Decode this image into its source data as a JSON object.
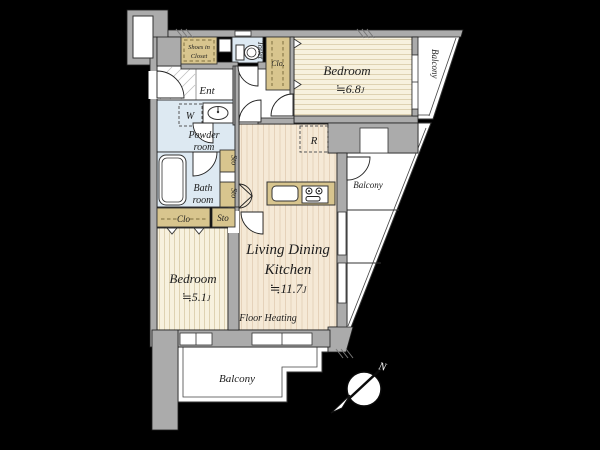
{
  "colors": {
    "background": "#000000",
    "wall": "#ababab",
    "outline": "#1f1f1f",
    "wood_floor": "#f7f1de",
    "wood_stripe": "#ded2b2",
    "ldk_floor": "#f5e9d6",
    "water_room": "#dde9f2",
    "closet": "#d8c58e",
    "balcony": "#ffffff"
  },
  "rooms": {
    "bedroom_top_right": {
      "name": "Bedroom",
      "area": "≒6.8",
      "area_unit": "J"
    },
    "bedroom_bottom_left": {
      "name": "Bedroom",
      "area": "≒5.1",
      "area_unit": "J"
    },
    "ldk": {
      "name_line1": "Living Dining",
      "name_line2": "Kitchen",
      "area": "≒11.7",
      "area_unit": "J",
      "floor_note": "Floor Heating"
    },
    "entrance": {
      "label": "Ent"
    },
    "powder_room": {
      "label_line1": "Powder",
      "label_line2": "room"
    },
    "bath_room": {
      "label_line1": "Bath",
      "label_line2": "room"
    },
    "toilet": {
      "label": "Toilet"
    },
    "shoes_closet": {
      "label_line1": "Shoes in",
      "label_line2": "Closet"
    },
    "washer_space": {
      "label": "W"
    },
    "refrigerator_space": {
      "label": "R"
    },
    "closet_upper": {
      "label": "Clo."
    },
    "closet_lower": {
      "label": "Clo"
    },
    "storage_1": {
      "label": "Sto"
    },
    "storage_2": {
      "label": "Sto"
    },
    "storage_3": {
      "label": "Sto"
    }
  },
  "balconies": {
    "top_right": "Balcony",
    "right": "Balcony",
    "bottom": "Balcony"
  },
  "compass": {
    "north_label": "N"
  }
}
